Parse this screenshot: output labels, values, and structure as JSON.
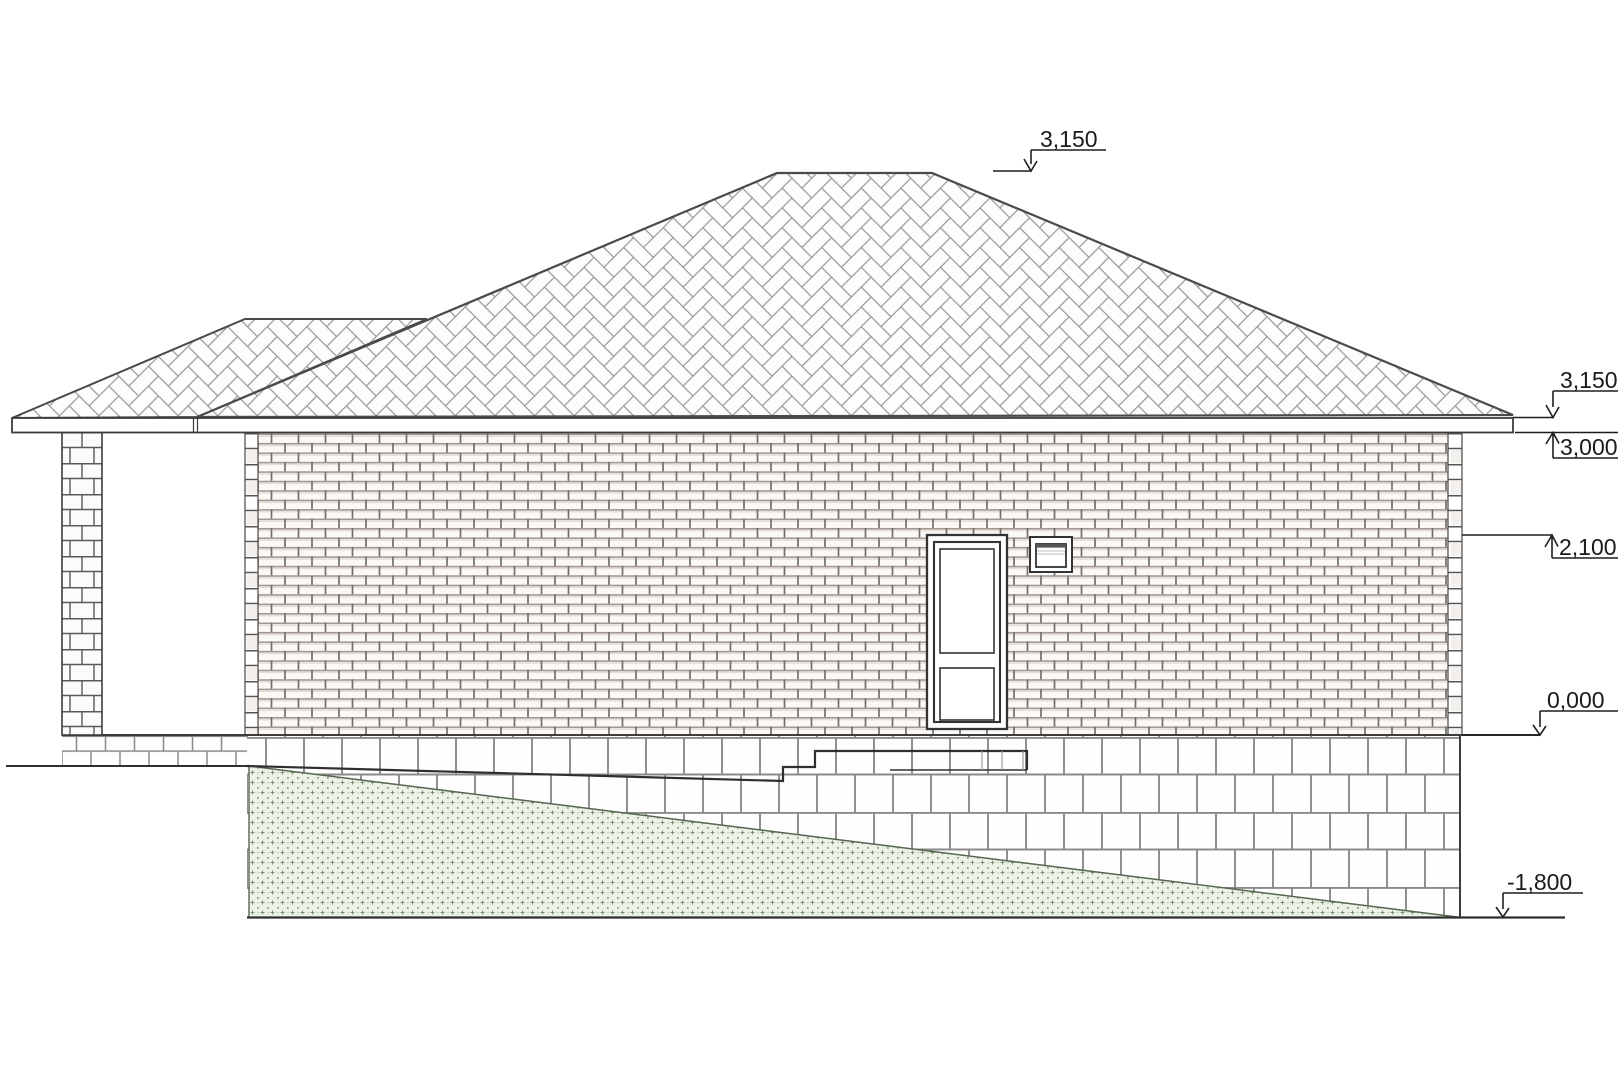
{
  "title": "House side elevation drawing",
  "elevation_marks": {
    "roof_ridge": {
      "label": "3,150"
    },
    "eaves_top": {
      "label": "3,150"
    },
    "eaves_bottom": {
      "label": "3,000"
    },
    "openings_top": {
      "label": "2,100"
    },
    "floor_level": {
      "label": "0,000"
    },
    "ground_level": {
      "label": "-1,800"
    }
  },
  "levels_mm": [
    3150,
    3150,
    3000,
    2100,
    0,
    -1800
  ],
  "colors": {
    "outline": "#3c3c3c",
    "roof_hatch": "#969696",
    "wall_joint_h": "#a2968f",
    "wall_joint_v": "#6f6f6f",
    "block_joint": "#8a8a8a",
    "terrain_bg": "#edf2e8",
    "terrain_dot": "#7b8e77",
    "ground_line": "#2f2f2f"
  }
}
